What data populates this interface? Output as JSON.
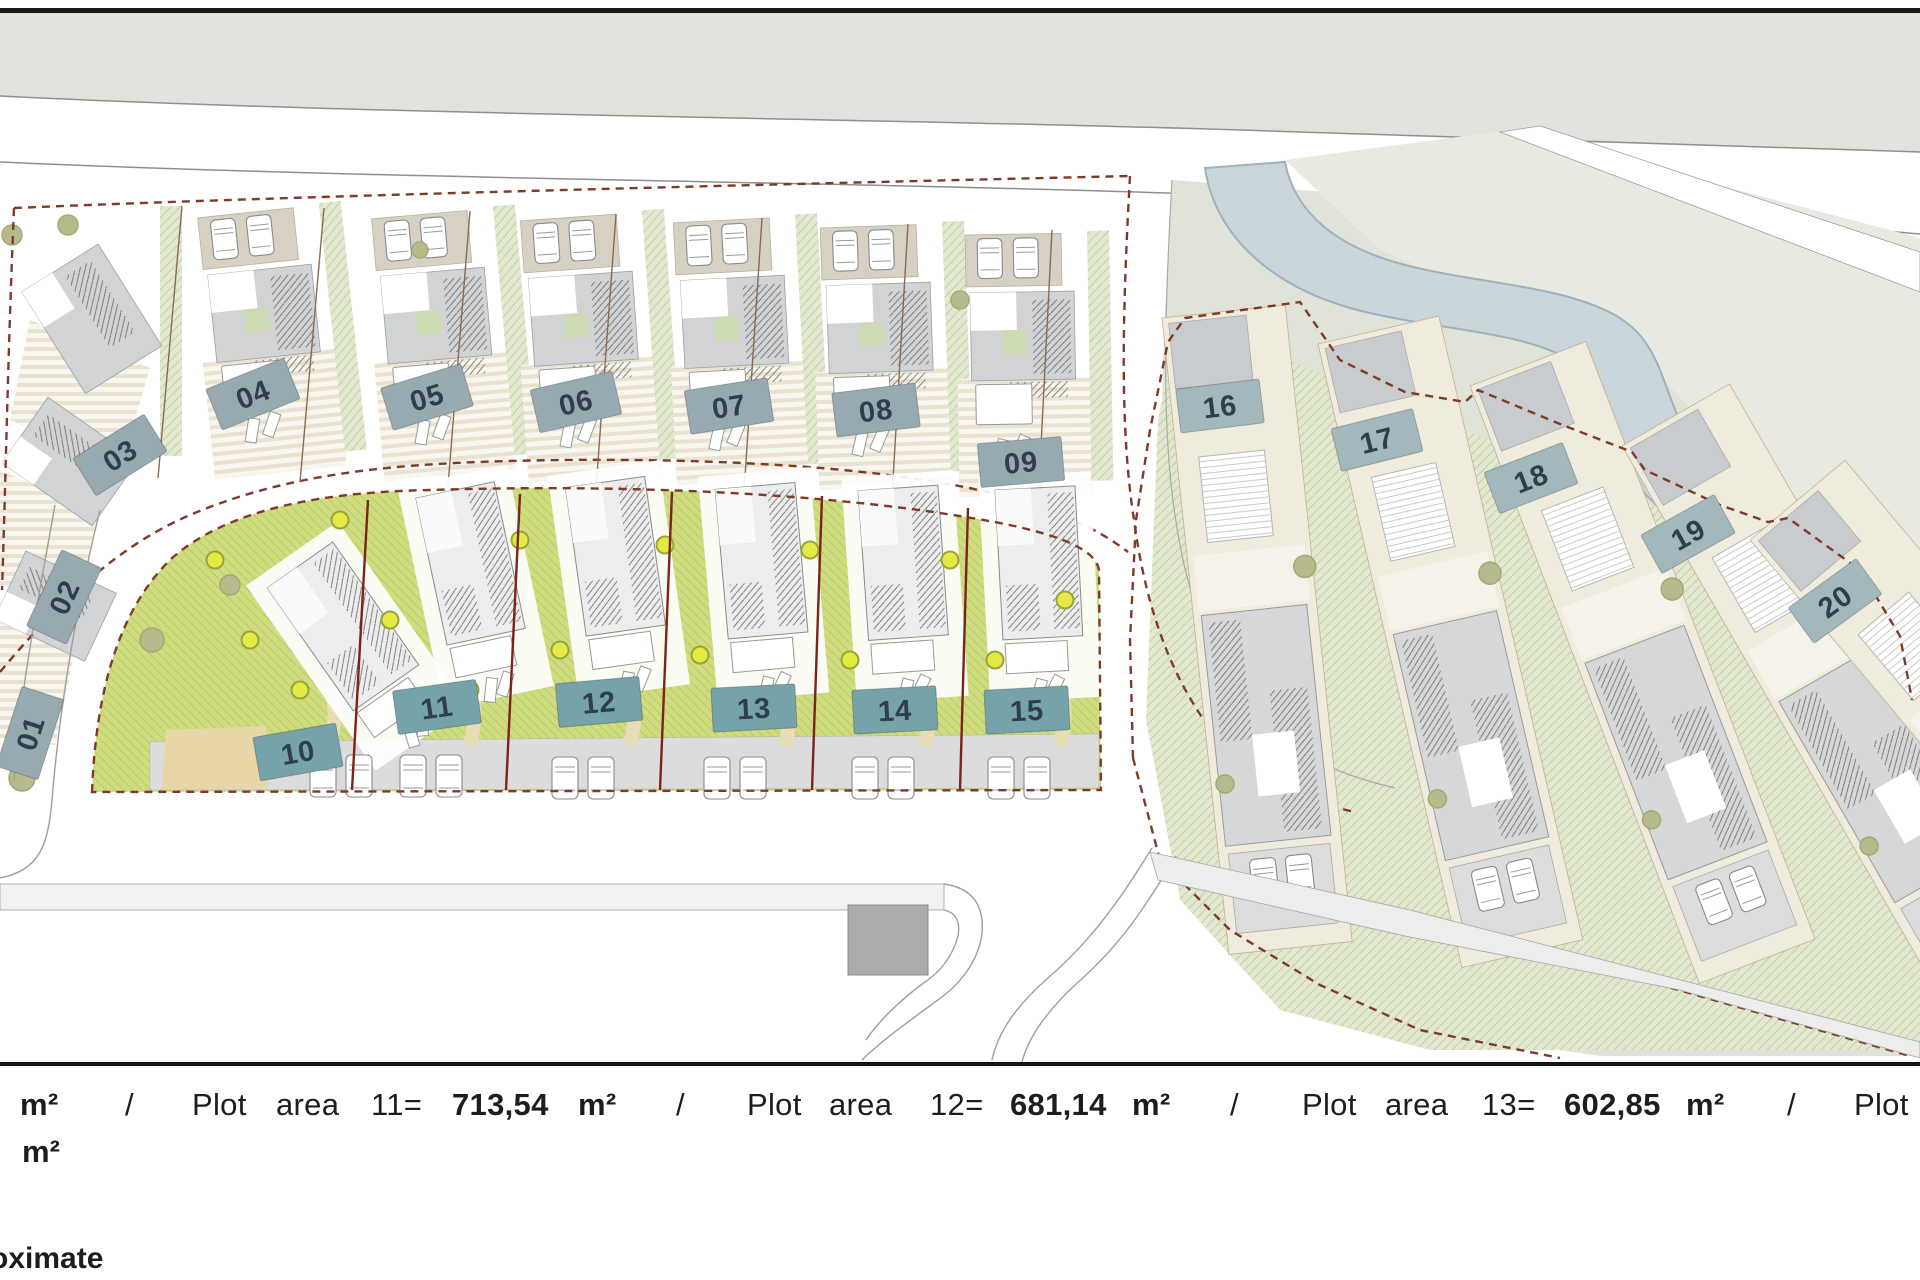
{
  "plan": {
    "plots": [
      {
        "id": "01"
      },
      {
        "id": "02"
      },
      {
        "id": "03"
      },
      {
        "id": "04"
      },
      {
        "id": "05"
      },
      {
        "id": "06"
      },
      {
        "id": "07"
      },
      {
        "id": "08"
      },
      {
        "id": "09"
      },
      {
        "id": "10"
      },
      {
        "id": "11"
      },
      {
        "id": "12"
      },
      {
        "id": "13"
      },
      {
        "id": "14"
      },
      {
        "id": "15"
      },
      {
        "id": "16"
      },
      {
        "id": "17"
      },
      {
        "id": "18"
      },
      {
        "id": "19"
      },
      {
        "id": "20"
      }
    ]
  },
  "legend": {
    "line1": [
      {
        "text": "m²",
        "bold": true
      },
      {
        "text": "/",
        "bold": false
      },
      {
        "text": "Plot",
        "bold": false
      },
      {
        "text": "area",
        "bold": false
      },
      {
        "text": "11=",
        "bold": false
      },
      {
        "text": "713,54",
        "bold": true
      },
      {
        "text": "m²",
        "bold": true
      },
      {
        "text": "/",
        "bold": false
      },
      {
        "text": "Plot",
        "bold": false
      },
      {
        "text": "area",
        "bold": false
      },
      {
        "text": "12=",
        "bold": false
      },
      {
        "text": "681,14",
        "bold": true
      },
      {
        "text": "m²",
        "bold": true
      },
      {
        "text": "/",
        "bold": false
      },
      {
        "text": "Plot",
        "bold": false
      },
      {
        "text": "area",
        "bold": false
      },
      {
        "text": "13=",
        "bold": false
      },
      {
        "text": "602,85",
        "bold": true
      },
      {
        "text": "m²",
        "bold": true
      },
      {
        "text": "/",
        "bold": false
      },
      {
        "text": "Plot",
        "bold": false
      }
    ],
    "line2": "m²",
    "note": "oximate"
  },
  "colors": {
    "top_band": "#e1e3dc",
    "sage": "#e0e4d8",
    "sage_light": "#e8eae2",
    "river": "#c8d5da",
    "river_edge": "#9fb2bb",
    "road_line": "#9a9a9a",
    "boundary_dash": "#7d3b2a",
    "divider_mid": "#7a241b",
    "divider_warm": "#8a6b52",
    "garden_mid": "#cfdc80",
    "stripe_cream": "#e9e2d1",
    "parking_tan": "#d7d1c3",
    "roof_gray": "#d2d3d5",
    "house_gray": "#d6d7d8",
    "house_light": "#ededee",
    "cream_plot": "#efecdd",
    "driveway": "#dcdcdc",
    "path_beige": "#e9ddb8",
    "sand": "#e7d7a6",
    "tree_yellow": "#e5e944",
    "tree_khaki": "#b7bb8b",
    "label_upper": "#97a9b1",
    "label_mid": "#76a2a9",
    "label_right": "#a3b8bc",
    "label_text": "#2e3e4a",
    "building_gray": "#ababab",
    "legend_text": "#1d1d1d"
  }
}
